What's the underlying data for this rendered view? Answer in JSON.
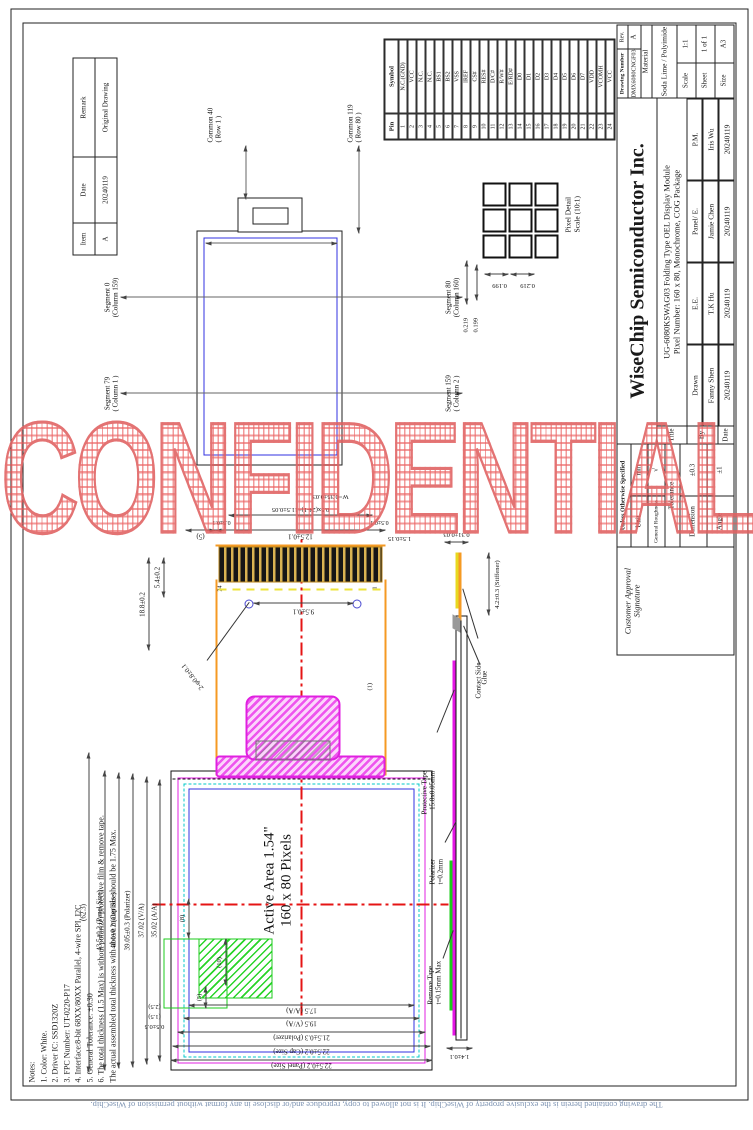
{
  "watermark": "CONFIDENTIAL",
  "footer": "The drawing contained herein is the exclusive property of WiseChip. It is not allowed to copy, reproduce and/or disclose in any format without permission of WiseChip.",
  "revision": {
    "header_item": "Item",
    "header_date": "Date",
    "header_remark": "Remark",
    "item": "A",
    "date": "20240119",
    "remark": "Original Drawing"
  },
  "notes": {
    "heading": "Notes:",
    "items": [
      "1. Color: White.",
      "2. Driver IC: SSD1320Z",
      "3. FPC Number: UT-0220-P17",
      "4. Interface:8-bit 68XX/80XX Parallel, 4-wire SPI, I2C",
      "5. General Tolerance: ±0.30",
      "6. The total thickness (1.5 Max) is without polarizer protective film & remove tape.",
      "The actual assembled total thickness with above materials should be 1.75 Max."
    ]
  },
  "schematic": {
    "common_top_1": "Common 40",
    "common_top_2": "( Row 1 )",
    "common_bot_1": "Common 119",
    "common_bot_2": "( Row 80 )",
    "seg_tl_1": "Segment 79",
    "seg_tl_2": "( Column 1 )",
    "seg_tr_1": "Segment 0",
    "seg_tr_2": "(Column 159)",
    "seg_bl_1": "Segment 159",
    "seg_bl_2": "( Column 2 )",
    "seg_br_1": "Segment 80",
    "seg_br_2": "(Column 160)"
  },
  "pixel_detail": {
    "title_1": "Pixel Detail",
    "title_2": "Scale (10:1)",
    "dim_col_pitch": "0.219",
    "dim_col": "0.199",
    "dim_row": "0.199",
    "dim_row_pitch": "0.219"
  },
  "pin_table": {
    "header_pin": "Pin",
    "header_symbol": "Symbol",
    "pins": [
      {
        "pin": "1",
        "symbol": "N.C.(GND)"
      },
      {
        "pin": "2",
        "symbol": "VCC"
      },
      {
        "pin": "3",
        "symbol": "N.C."
      },
      {
        "pin": "4",
        "symbol": "N.C."
      },
      {
        "pin": "5",
        "symbol": "BS1"
      },
      {
        "pin": "6",
        "symbol": "BS2"
      },
      {
        "pin": "7",
        "symbol": "VSS"
      },
      {
        "pin": "8",
        "symbol": "IREF"
      },
      {
        "pin": "9",
        "symbol": "CS#"
      },
      {
        "pin": "10",
        "symbol": "RES#"
      },
      {
        "pin": "11",
        "symbol": "D/C#"
      },
      {
        "pin": "12",
        "symbol": "R/W#"
      },
      {
        "pin": "13",
        "symbol": "E/RD#"
      },
      {
        "pin": "14",
        "symbol": "D0"
      },
      {
        "pin": "15",
        "symbol": "D1"
      },
      {
        "pin": "16",
        "symbol": "D2"
      },
      {
        "pin": "17",
        "symbol": "D3"
      },
      {
        "pin": "18",
        "symbol": "D4"
      },
      {
        "pin": "19",
        "symbol": "D5"
      },
      {
        "pin": "20",
        "symbol": "D6"
      },
      {
        "pin": "21",
        "symbol": "D7"
      },
      {
        "pin": "22",
        "symbol": "VDD"
      },
      {
        "pin": "23",
        "symbol": "VCOMH"
      },
      {
        "pin": "24",
        "symbol": "VCC"
      }
    ]
  },
  "front_view": {
    "active_area_line1": "Active Area 1.54\"",
    "active_area_line2": "160 x 80 Pixels",
    "dim_overall": "(62.3)",
    "dim_panel_w": "43.5±0.2 (Panel Size)",
    "dim_cap_w": "40.1±0.2 (Cap Size)",
    "dim_pol_w": "39.05±0.3 (Polarizer)",
    "dim_va_w": "37.02 (V/A)",
    "dim_aa_w": "35.02 (A/A)",
    "dim_panel_h": "22.5±0.2 (Panel Size)",
    "dim_cap_h": "22.5±0.2 (Cap Size)",
    "dim_pol_h": "21.5±0.3 (Polarizer)",
    "dim_va_h": "19.5 (V/A)",
    "dim_aa_h": "17.5 (A/A)",
    "dim_05": "0.5±0.5",
    "dim_15": "(1.5)",
    "dim_25": "(2.5)",
    "dim_g5": "(5)",
    "dim_g10": "(10)",
    "dim_g8": "(8)"
  },
  "fpc": {
    "dim_length": "18.8±0.2",
    "dim_54": "5.4±0.2",
    "dim_holes": "9.5±0.1",
    "dim_hole_dia": "2-φ0.8±0.1",
    "dim_width": "12.5±0.1",
    "dim_5": "(5)",
    "dim_margin_top": "0.5±0.1",
    "dim_margin_bot": "0.5±0.1",
    "dim_pitch": "0.5x(24-1)=11.5±0.05",
    "dim_finger_w": "W=0.35±0.03",
    "dim_finger_len": "1.5±0.15",
    "dim_1": "(1)",
    "pin_first": "1",
    "pin_last": "24"
  },
  "side_view": {
    "contact_side": "Contact Side",
    "stiffener": "4.2±0.3 (Stiffener)",
    "protective_tape_1": "Protective Tape",
    "protective_tape_2": "15.8x0.05mm",
    "glue": "Glue",
    "polarizer_1": "Polarizer",
    "polarizer_2": "t=0.2mm",
    "remove_tape_1": "Remove Tape",
    "remove_tape_2": "t=0.15mm Max",
    "dim_total": "1.4±0.1",
    "dim_fpc": "0.31±0.03"
  },
  "title_block": {
    "customer_approval_1": "Customer Approval",
    "customer_approval_2": "Signature",
    "unless": "Unless Otherwise Specified",
    "unit_label": "Unit",
    "unit_value": "mm",
    "roughness_label": "General Roughness",
    "roughness_symbol": "√",
    "tolerance_label": "Tolerance",
    "dimension_label": "Dimension",
    "dimension_value": "±0.3",
    "angle_label": "Angle",
    "angle_value": "±1",
    "row_title": "Title",
    "row_by": "By",
    "row_date": "Date",
    "company": "WiseChip Semiconductor Inc.",
    "title_line1": "UG-6080KSWAG03 Folding Type OEL Display Module",
    "title_line2": "Pixel Number: 160 x 80, Monochrome, COG Package",
    "roles": [
      {
        "role": "Drawn",
        "name": "Fanny Shen",
        "date": "20240119"
      },
      {
        "role": "E.E.",
        "name": "T.K Hu",
        "date": "20240119"
      },
      {
        "role": "Panel/ E.",
        "name": "Jamie Chen",
        "date": "20240119"
      },
      {
        "role": "P.M.",
        "name": "Iris Wu",
        "date": "20240119"
      }
    ],
    "drawing_number_label": "Drawing Number",
    "drawing_number": "DMX6080CNGF03",
    "rev_label": "Rev.",
    "rev": "A",
    "material_label": "Material",
    "material": "Soda Lime / Polyimide",
    "scale_label": "Scale",
    "scale": "1:1",
    "sheet_label": "Sheet",
    "sheet": "1 of 1",
    "size_label": "Size",
    "size": "A3"
  },
  "colors": {
    "watermark_red": "#e06060",
    "fpc_orange": "#f59a23",
    "stiffener_magenta": "#e020e0",
    "active_area_blue": "#3030e0",
    "va_cyan": "#00c8c8",
    "tape_green": "#1ecb1e",
    "centerline_red": "#e51414",
    "footer_blue_gray": "#7d93b2"
  }
}
